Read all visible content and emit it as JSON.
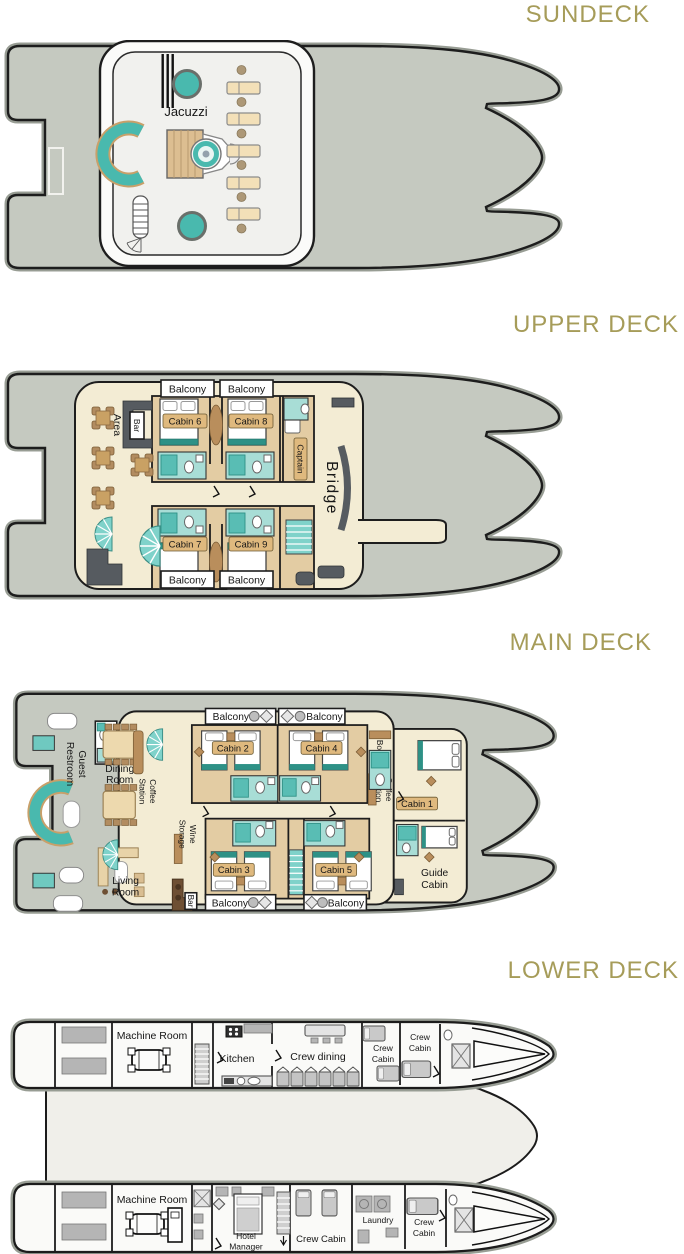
{
  "palette": {
    "title_gold": "#A69C59",
    "hull_gray": "#C5C9C0",
    "outline": "#1D1D1D",
    "interior_cream": "#F3ECD4",
    "cabin_tan": "#E3CCA3",
    "label_chip": "#DFB97E",
    "bathroom_teal": "#A8DDD6",
    "accent_teal": "#49B9AE",
    "wood_brown": "#B98E5C",
    "dark_gray": "#565B60"
  },
  "decks": [
    {
      "title": "SUNDECK",
      "labels": {
        "jacuzzi": "Jacuzzi"
      }
    },
    {
      "title": "UPPER DECK",
      "labels": {
        "balcony": "Balcony",
        "bbq": [
          "BBQ",
          "Area"
        ],
        "bar": "Bar",
        "cabin6": "Cabin 6",
        "cabin8": "Cabin 8",
        "cabin7": "Cabin 7",
        "cabin9": "Cabin 9",
        "captain": "Captain",
        "bridge": "Bridge"
      }
    },
    {
      "title": "MAIN DECK",
      "labels": {
        "balcony": "Balcony",
        "guest_restroom": [
          "Guest",
          "Restroom"
        ],
        "dining": [
          "Dining",
          "Room"
        ],
        "coffee": [
          "Coffee",
          "Station"
        ],
        "wine": [
          "Wine",
          "Storage"
        ],
        "living": [
          "Living",
          "Room"
        ],
        "bar": "Bar",
        "boutique": "Boutique",
        "cabin1": "Cabin 1",
        "cabin2": "Cabin 2",
        "cabin3": "Cabin 3",
        "cabin4": "Cabin 4",
        "cabin5": "Cabin 5",
        "guide": [
          "Guide",
          "Cabin"
        ]
      }
    },
    {
      "title": "LOWER DECK",
      "labels": {
        "machine_room": "Machine Room",
        "kitchen": "Kitchen",
        "crew_dining": "Crew dining",
        "crew_cabin": [
          "Crew",
          "Cabin"
        ],
        "crew_cabin_single": "Crew Cabin",
        "hotel_manager": [
          "Hotel",
          "Manager"
        ],
        "laundry": "Laundry"
      }
    }
  ]
}
